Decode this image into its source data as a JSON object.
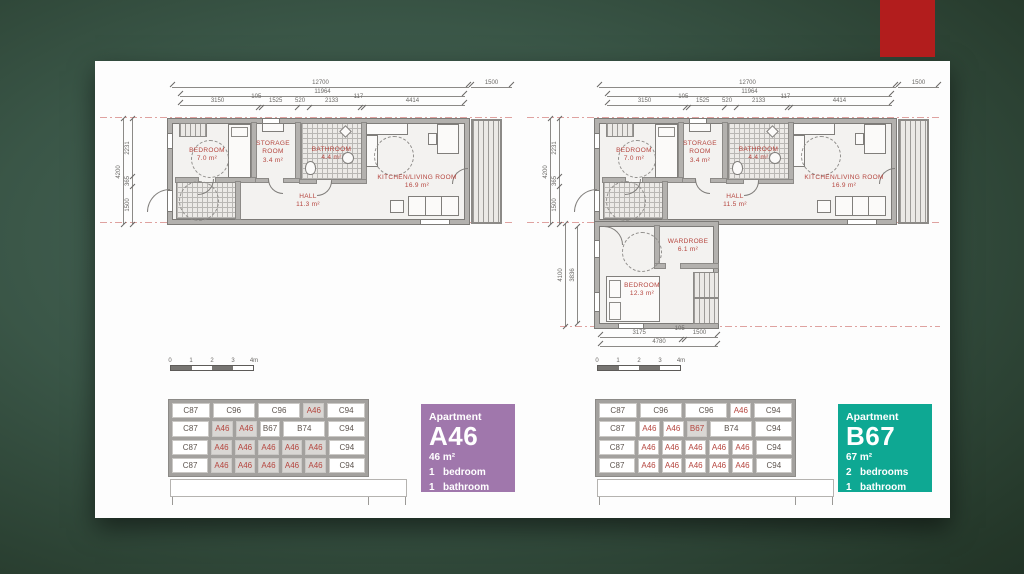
{
  "slide": {
    "accent_color": "#b21d1d"
  },
  "plan_a46": {
    "top_dims": {
      "overall": "12700",
      "balcony": "1500",
      "inner": "11964",
      "segments": [
        3150,
        105,
        1525,
        520,
        2133,
        117,
        4414
      ]
    },
    "left_dims": {
      "overall": "4200",
      "segments": [
        2231,
        365,
        1500
      ]
    },
    "rooms": [
      {
        "name": "BEDROOM",
        "area": "7.0 m²"
      },
      {
        "name": "STORAGE ROOM",
        "area": "3.4 m²"
      },
      {
        "name": "BATHROOM",
        "area": "4.4 m²"
      },
      {
        "name": "HALL",
        "area": "11.3 m²"
      },
      {
        "name": "KITCHEN/LIVING ROOM",
        "area": "16.9 m²"
      }
    ]
  },
  "plan_b67": {
    "top_dims": {
      "overall": "12700",
      "balcony": "1500",
      "inner": "11964",
      "segments": [
        3150,
        105,
        1525,
        520,
        2133,
        117,
        4414
      ]
    },
    "left_dims": {
      "overall": "4200",
      "segments": [
        2231,
        365,
        1500
      ]
    },
    "left_dims_lower": {
      "overall": "4100",
      "inner": "3836"
    },
    "bottom_dims": {
      "overall": "4780",
      "segments": [
        3175,
        105,
        1500
      ]
    },
    "rooms": [
      {
        "name": "BEDROOM",
        "area": "7.0 m²"
      },
      {
        "name": "STORAGE ROOM",
        "area": "3.4 m²"
      },
      {
        "name": "BATHROOM",
        "area": "4.4 m²"
      },
      {
        "name": "HALL",
        "area": "11.5 m²"
      },
      {
        "name": "KITCHEN/LIVING ROOM",
        "area": "16.9 m²"
      },
      {
        "name": "WARDROBE",
        "area": "6.1 m²"
      },
      {
        "name": "BEDROOM",
        "area": "12.3 m²"
      }
    ]
  },
  "scale_bar": {
    "labels": [
      "0",
      "1",
      "2",
      "3",
      "4m"
    ]
  },
  "elevation": {
    "left": {
      "rows": [
        [
          {
            "label": "C87",
            "wide": 1
          },
          {
            "label": "C96",
            "sp2": 1
          },
          {
            "label": "C96",
            "sp2": 1
          },
          {
            "label": "A46",
            "hl": 1,
            "red": 1
          },
          {
            "label": "C94",
            "wide": 1
          }
        ],
        [
          {
            "label": "C87",
            "wide": 1
          },
          {
            "label": "A46",
            "hl": 1,
            "red": 1
          },
          {
            "label": "A46",
            "hl": 1,
            "red": 1
          },
          {
            "label": "B67"
          },
          {
            "label": "B74",
            "sp2": 1
          },
          {
            "label": "C94",
            "wide": 1
          }
        ],
        [
          {
            "label": "C87",
            "wide": 1
          },
          {
            "label": "A46",
            "hl": 1,
            "red": 1
          },
          {
            "label": "A46",
            "hl": 1,
            "red": 1
          },
          {
            "label": "A46",
            "hl": 1,
            "red": 1
          },
          {
            "label": "A46",
            "hl": 1,
            "red": 1
          },
          {
            "label": "A46",
            "hl": 1,
            "red": 1
          },
          {
            "label": "C94",
            "wide": 1
          }
        ],
        [
          {
            "label": "C87",
            "wide": 1
          },
          {
            "label": "A46",
            "hl": 1,
            "red": 1
          },
          {
            "label": "A46",
            "hl": 1,
            "red": 1
          },
          {
            "label": "A46",
            "hl": 1,
            "red": 1
          },
          {
            "label": "A46",
            "hl": 1,
            "red": 1
          },
          {
            "label": "A46",
            "hl": 1,
            "red": 1
          },
          {
            "label": "C94",
            "wide": 1
          }
        ]
      ]
    },
    "right": {
      "rows": [
        [
          {
            "label": "C87",
            "wide": 1
          },
          {
            "label": "C96",
            "sp2": 1
          },
          {
            "label": "C96",
            "sp2": 1
          },
          {
            "label": "A46",
            "red": 1
          },
          {
            "label": "C94",
            "wide": 1
          }
        ],
        [
          {
            "label": "C87",
            "wide": 1
          },
          {
            "label": "A46",
            "red": 1
          },
          {
            "label": "A46",
            "red": 1
          },
          {
            "label": "B67",
            "hl": 1,
            "red": 1
          },
          {
            "label": "B74",
            "sp2": 1
          },
          {
            "label": "C94",
            "wide": 1
          }
        ],
        [
          {
            "label": "C87",
            "wide": 1
          },
          {
            "label": "A46",
            "red": 1
          },
          {
            "label": "A46",
            "red": 1
          },
          {
            "label": "A46",
            "red": 1
          },
          {
            "label": "A46",
            "red": 1
          },
          {
            "label": "A46",
            "red": 1
          },
          {
            "label": "C94",
            "wide": 1
          }
        ],
        [
          {
            "label": "C87",
            "wide": 1
          },
          {
            "label": "A46",
            "red": 1
          },
          {
            "label": "A46",
            "red": 1
          },
          {
            "label": "A46",
            "red": 1
          },
          {
            "label": "A46",
            "red": 1
          },
          {
            "label": "A46",
            "red": 1
          },
          {
            "label": "C94",
            "wide": 1
          }
        ]
      ]
    }
  },
  "cards": {
    "a46": {
      "label": "Apartment",
      "code": "A46",
      "area": "46 m²",
      "color": "#a077ac",
      "rows": [
        {
          "n": "1",
          "t": "bedroom"
        },
        {
          "n": "1",
          "t": "bathroom"
        }
      ]
    },
    "b67": {
      "label": "Apartment",
      "code": "B67",
      "area": "67 m²",
      "color": "#0ea893",
      "rows": [
        {
          "n": "2",
          "t": "bedrooms"
        },
        {
          "n": "1",
          "t": "bathroom"
        }
      ]
    }
  }
}
